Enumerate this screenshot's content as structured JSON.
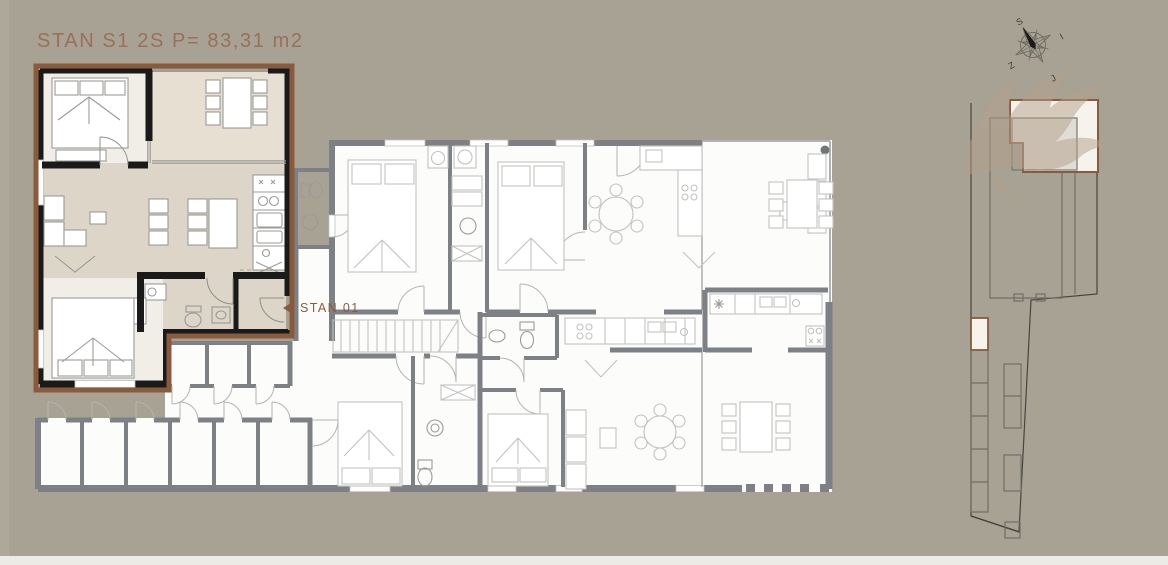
{
  "header": {
    "title": "STAN S1 2S P= 83,31 m2"
  },
  "unit": {
    "label": "STAN 01",
    "area_m2": "83,31",
    "rooms": "2S",
    "id": "S1"
  },
  "compass": {
    "north": "S",
    "east": "I",
    "south": "J",
    "west": "Z"
  },
  "colors": {
    "bg": "#a8a294",
    "edge": "#b1ab9e",
    "strip": "#ecebe5",
    "brown": "#9a7058",
    "outline": "#8a5a3d",
    "blackwall": "#1a1a1a",
    "graywall": "#7d8185",
    "room": "#fcfcfb",
    "living": "#dcd5c8",
    "terrace": "#e6dfd2",
    "bedroom": "#f1eee7",
    "furn": "#c2c2c0",
    "furndark": "#9a9a96",
    "siteline": "#45453f",
    "sitebuild": "#6f6f67",
    "highlight": "#f6f3ec",
    "eagle": "#b3a08a",
    "needle": "#1b1b1b",
    "dot": "#70757a"
  }
}
